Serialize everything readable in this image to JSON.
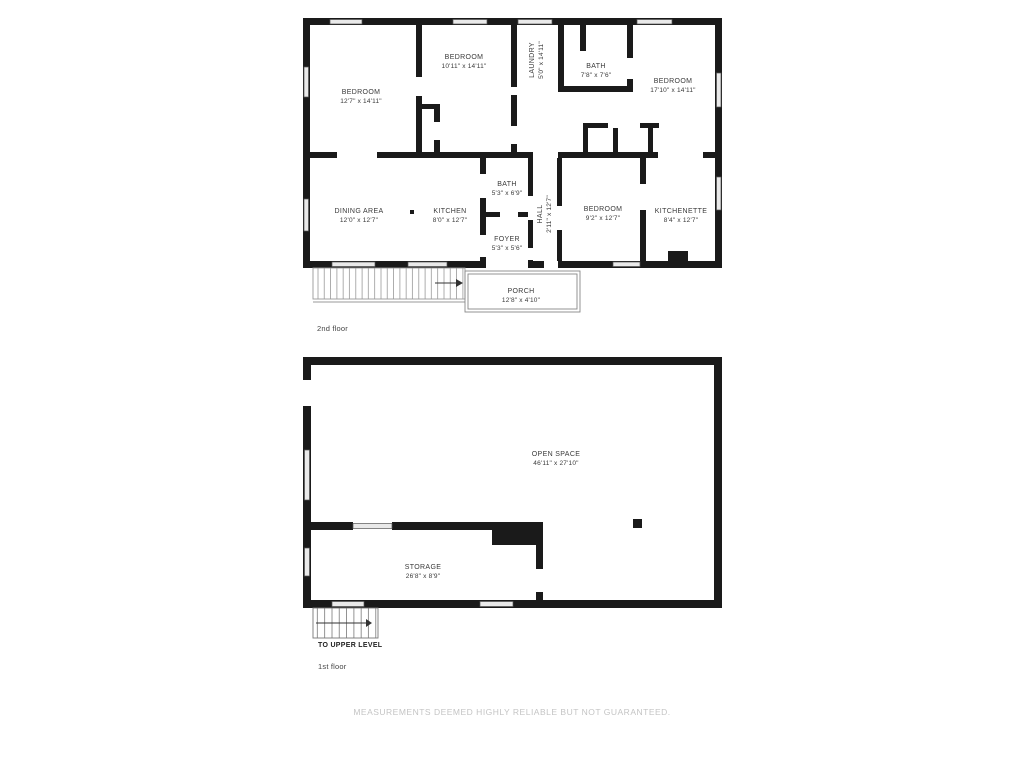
{
  "disclaimer": "MEASUREMENTS DEEMED HIGHLY RELIABLE BUT NOT GUARANTEED.",
  "floors": [
    {
      "caption": "2nd floor",
      "rooms": [
        {
          "name": "BEDROOM",
          "dims": "12'7\" x 14'11\""
        },
        {
          "name": "BEDROOM",
          "dims": "10'11\" x 14'11\""
        },
        {
          "name": "LAUNDRY",
          "dims": "5'0\" x 14'11\""
        },
        {
          "name": "BATH",
          "dims": "7'8\" x 7'6\""
        },
        {
          "name": "BEDROOM",
          "dims": "17'10\" x 14'11\""
        },
        {
          "name": "DINING AREA",
          "dims": "12'0\" x 12'7\""
        },
        {
          "name": "KITCHEN",
          "dims": "8'0\" x 12'7\""
        },
        {
          "name": "BATH",
          "dims": "5'3\" x 6'9\""
        },
        {
          "name": "FOYER",
          "dims": "5'3\" x 5'6\""
        },
        {
          "name": "HALL",
          "dims": "2'11\" x 12'7\""
        },
        {
          "name": "BEDROOM",
          "dims": "9'2\" x 12'7\""
        },
        {
          "name": "KITCHENETTE",
          "dims": "8'4\" x 12'7\""
        },
        {
          "name": "PORCH",
          "dims": "12'8\" x 4'10\""
        }
      ]
    },
    {
      "caption": "1st floor",
      "stairs_label": "TO UPPER LEVEL",
      "rooms": [
        {
          "name": "OPEN SPACE",
          "dims": "46'11\" x 27'10\""
        },
        {
          "name": "STORAGE",
          "dims": "26'8\" x 8'9\""
        }
      ]
    }
  ],
  "colors": {
    "wall": "#1a1a1a",
    "window_fill": "#e9e9e9",
    "deck_line": "#999999",
    "disclaimer_text": "#c4c4c4"
  }
}
